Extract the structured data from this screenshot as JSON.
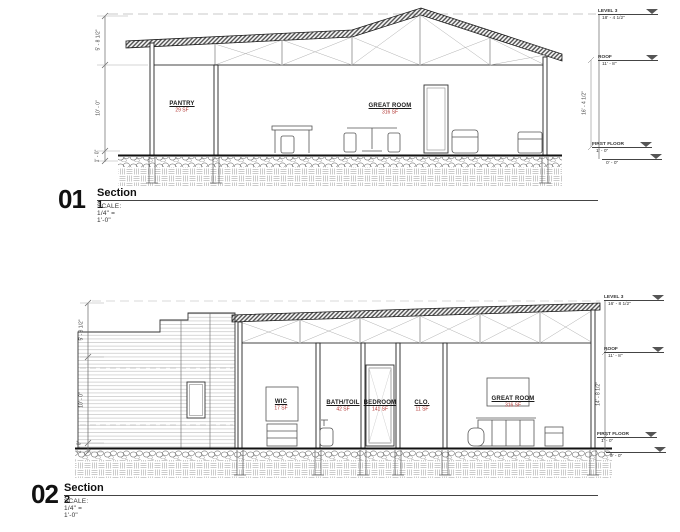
{
  "titles": {
    "s1": {
      "num": "01",
      "name": "Section 1",
      "scale": "SCALE:  1/4\" = 1'-0\""
    },
    "s2": {
      "num": "02",
      "name": "Section 2",
      "scale": "SCALE:  1/4\" = 1'-0\""
    }
  },
  "s1": {
    "rooms": {
      "pantry": {
        "name": "PANTRY",
        "area": "29 SF"
      },
      "great": {
        "name": "GREAT ROOM",
        "area": "316 SF"
      }
    },
    "dims": {
      "left_top": "5' - 8 1/2\"",
      "left_mid": "10' - 0\"",
      "left_bot": "1' - 0\"",
      "right": "16' - 4 1/2\""
    },
    "levels": {
      "l3": {
        "name": "LEVEL 3",
        "elev": "18' - 4 1/2\""
      },
      "roof": {
        "name": "ROOF",
        "elev": "11' - 8\""
      },
      "ff": {
        "name": "FIRST FLOOR",
        "elev": "1' - 0\""
      },
      "grade": {
        "name": "",
        "elev": "0' - 0\""
      }
    }
  },
  "s2": {
    "rooms": {
      "wic": {
        "name": "WIC",
        "area": "17 SF"
      },
      "bath": {
        "name": "BATH/TOIL",
        "area": "42 SF"
      },
      "bed": {
        "name": "BEDROOM",
        "area": "141 SF"
      },
      "clo": {
        "name": "CLO.",
        "area": "11 SF"
      },
      "great": {
        "name": "GREAT ROOM",
        "area": "316 SF"
      }
    },
    "dims": {
      "left_top": "5' - 8 1/2\"",
      "left_mid": "10' - 0\"",
      "left_bot": "1' - 0\"",
      "right": "14' - 8 1/2\""
    },
    "levels": {
      "l3": {
        "name": "LEVEL 3",
        "elev": "16' - 8 1/2\""
      },
      "roof": {
        "name": "ROOF",
        "elev": "11' - 8\""
      },
      "ff": {
        "name": "FIRST FLOOR",
        "elev": "1' - 0\""
      },
      "grade": {
        "name": "",
        "elev": "0' - 0\""
      }
    }
  },
  "colors": {
    "line": "#2a2a2a",
    "area_red": "#b03431",
    "hatch": "#9a9a9a"
  }
}
